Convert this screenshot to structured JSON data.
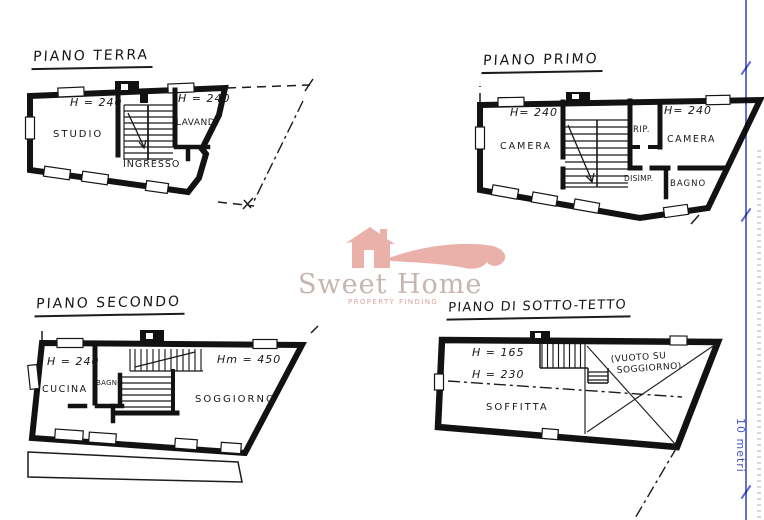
{
  "plans": {
    "terra": {
      "title": "PIANO TERRA",
      "height_left": "H = 240",
      "height_right": "H = 240",
      "room_studio": "STUDIO",
      "room_ingresso": "INGRESSO",
      "room_lavanderia": "LAVAND."
    },
    "primo": {
      "title": "PIANO PRIMO",
      "height_left": "H= 240",
      "height_right": "H= 240",
      "room_camera_left": "CAMERA",
      "room_rip": "RIP.",
      "room_camera_right": "CAMERA",
      "room_disimpegno": "DISIMP.",
      "room_bagno": "BAGNO"
    },
    "secondo": {
      "title": "PIANO SECONDO",
      "height_left": "H = 240",
      "height_right": "Hm = 450",
      "room_cucina": "CUCINA",
      "room_bagno": "BAGNO",
      "room_soggiorno": "SOGGIORNO"
    },
    "sottotetto": {
      "title": "PIANO DI SOTTO-TETTO",
      "height_1": "H = 165",
      "height_2": "H = 230",
      "room_soffitta": "SOFFITTA",
      "room_vuoto_line1": "(VUOTO SU",
      "room_vuoto_line2": "SOGGIORNO)"
    }
  },
  "watermark": {
    "brand": "Sweet Home",
    "tagline": "PROPERTY FINDING"
  },
  "scale_bar": {
    "label": "10 metri"
  },
  "colors": {
    "ink": "#1a1a1a",
    "logo_pink": "#e9b1aa",
    "logo_brand_text": "#c7b5b1",
    "logo_tagline": "#dba49d",
    "scale_blue": "#5b68cc"
  }
}
